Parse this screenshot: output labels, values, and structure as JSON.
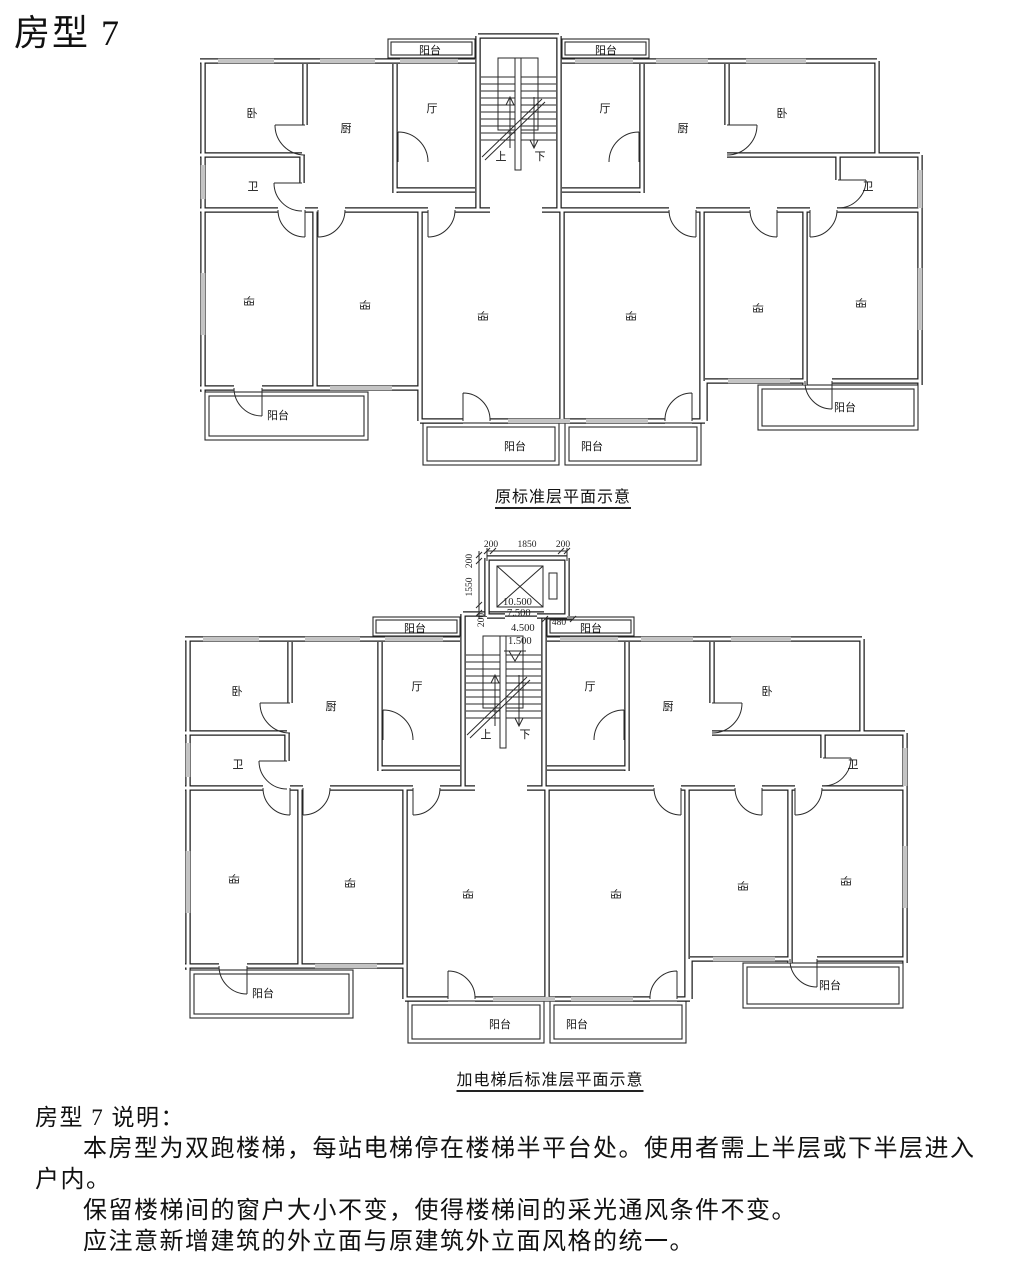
{
  "page_title": "房型 7",
  "plan_labels": {
    "balcony": "阳台",
    "bedroom": "卧",
    "kitchen": "厨",
    "living_room": "厅",
    "bathroom": "卫",
    "stair_up": "上",
    "stair_down": "下"
  },
  "captions": {
    "original": "原标准层平面示意",
    "after_elevator": "加电梯后标准层平面示意"
  },
  "elevator_dims": {
    "top": [
      "200",
      "1850",
      "200"
    ],
    "left": [
      "200",
      "1550",
      "200"
    ],
    "gap": "480",
    "stop_levels": [
      "10.500",
      "7.500",
      "4.500",
      "1.500"
    ]
  },
  "notes": {
    "heading": "房型 7 说明：",
    "para1_line1": "本房型为双跑楼梯，每站电梯停在楼梯半平台处。使用者需上半层或下半层进入",
    "para1_line2": "户内。",
    "para2": "保留楼梯间的窗户大小不变，使得楼梯间的采光通风条件不变。",
    "para3": "应注意新增建筑的外立面与原建筑外立面风格的统一。"
  },
  "colors": {
    "line": "#1e1e1e",
    "window_fill": "#c4c4c4",
    "background": "#ffffff"
  }
}
